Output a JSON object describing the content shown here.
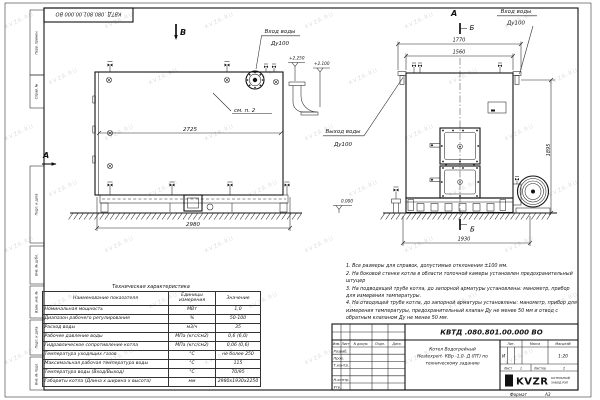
{
  "doc": {
    "stamp_number": "КВТД .080.801.00.000  ВО",
    "format_label": "Формат",
    "format_value": "А3"
  },
  "frame": {
    "left_labels": [
      "Перв. примен.",
      "Справ. №",
      "Подп. и дата",
      "Инв. № дубл.",
      "Взам. инв. №",
      "Подп. и дата",
      "Инв. № подл."
    ]
  },
  "views": {
    "front": {
      "label": "В",
      "section": "А",
      "inlet": "Вход воды",
      "inlet_dn": "Ду100",
      "outlet": "Выход воды",
      "outlet_dn": "Ду100",
      "see_note": "см. п. 2",
      "elev_top": "+2.250",
      "elev_mid": "+2.100",
      "elev_zero": "0.000",
      "dim_inner": "2725",
      "dim_overall": "2980"
    },
    "side": {
      "label": "А",
      "section_top": "Б",
      "section_bottom": "Б",
      "inlet": "Вход воды",
      "inlet_dn": "Ду100",
      "dim_flanges": "1770",
      "dim_body": "1560",
      "dim_height": "1895",
      "dim_base": "1930"
    }
  },
  "notes": [
    "1. Все размеры для справок, допустимые отклонения ±100 мм.",
    "2. На боковой стенке котла в области топочной камеры установлен предохранительный штуцер",
    "3. На подводящей трубе котла, до запорной арматуры установлены: манометр, прибор для измерения температуры.",
    "4. На отводящей трубе котла, до запорной арматуры установлены: манометр, прибор для измерения температуры, предохранительный клапан Ду не менее 50 мм и отвод с обратным клапаном Ду не менее 50 мм."
  ],
  "tech_table": {
    "title": "Техническая характеристика",
    "headers": [
      "Наименование показателя",
      "Единицы измерения",
      "Значение"
    ],
    "rows": [
      [
        "Номинальная мощность",
        "МВт",
        "1,0"
      ],
      [
        "Диапазон рабочего регулирования",
        "%",
        "50-100"
      ],
      [
        "Расход воды",
        "м3/ч",
        "35"
      ],
      [
        "Рабочее давление воды",
        "МПа (кгс/см2)",
        "0,6 (6,0)"
      ],
      [
        "Гидравлическое сопротивление котла",
        "МПа (кгс/см2)",
        "0,06 (0,6)"
      ],
      [
        "Температура уходящих газов",
        "°С",
        "не более 250"
      ],
      [
        "Максимальная рабочая температура воды",
        "°С",
        "115"
      ],
      [
        "Температура воды (Вход/Выход)",
        "°С",
        "70/95"
      ],
      [
        "Габариты котла (Длина х ширина х высота)",
        "мм",
        "2980х1930х2250"
      ]
    ]
  },
  "titleblock": {
    "number": "КВТД .080.801.00.000  ВО",
    "cols": [
      "Изм.",
      "Лист",
      "N докум.",
      "Подп.",
      "Дата"
    ],
    "sign_rows": [
      "Разраб.",
      "Пров.",
      "Т.контр.",
      "",
      "Н.контр.",
      "Утв."
    ],
    "name_line1": "Котел Водогрейный",
    "name_line2": "Heatexpert- КВр -1,0- Д (ПТ) по",
    "name_line3": "техническому заданию",
    "lit_label": "Лит.",
    "lit_value": "И",
    "mass_label": "Масса",
    "scale_label": "Масштаб",
    "scale_value": "1:20",
    "sheet_label": "Лист",
    "sheet_value": "1",
    "sheets_label": "Листов",
    "sheets_value": "2",
    "logo_text": "KVZR",
    "logo_caption1": "КОТЕЛЬНЫЙ",
    "logo_caption2": "ЗАВОД РЭП"
  },
  "watermark": "KVZR.RU"
}
